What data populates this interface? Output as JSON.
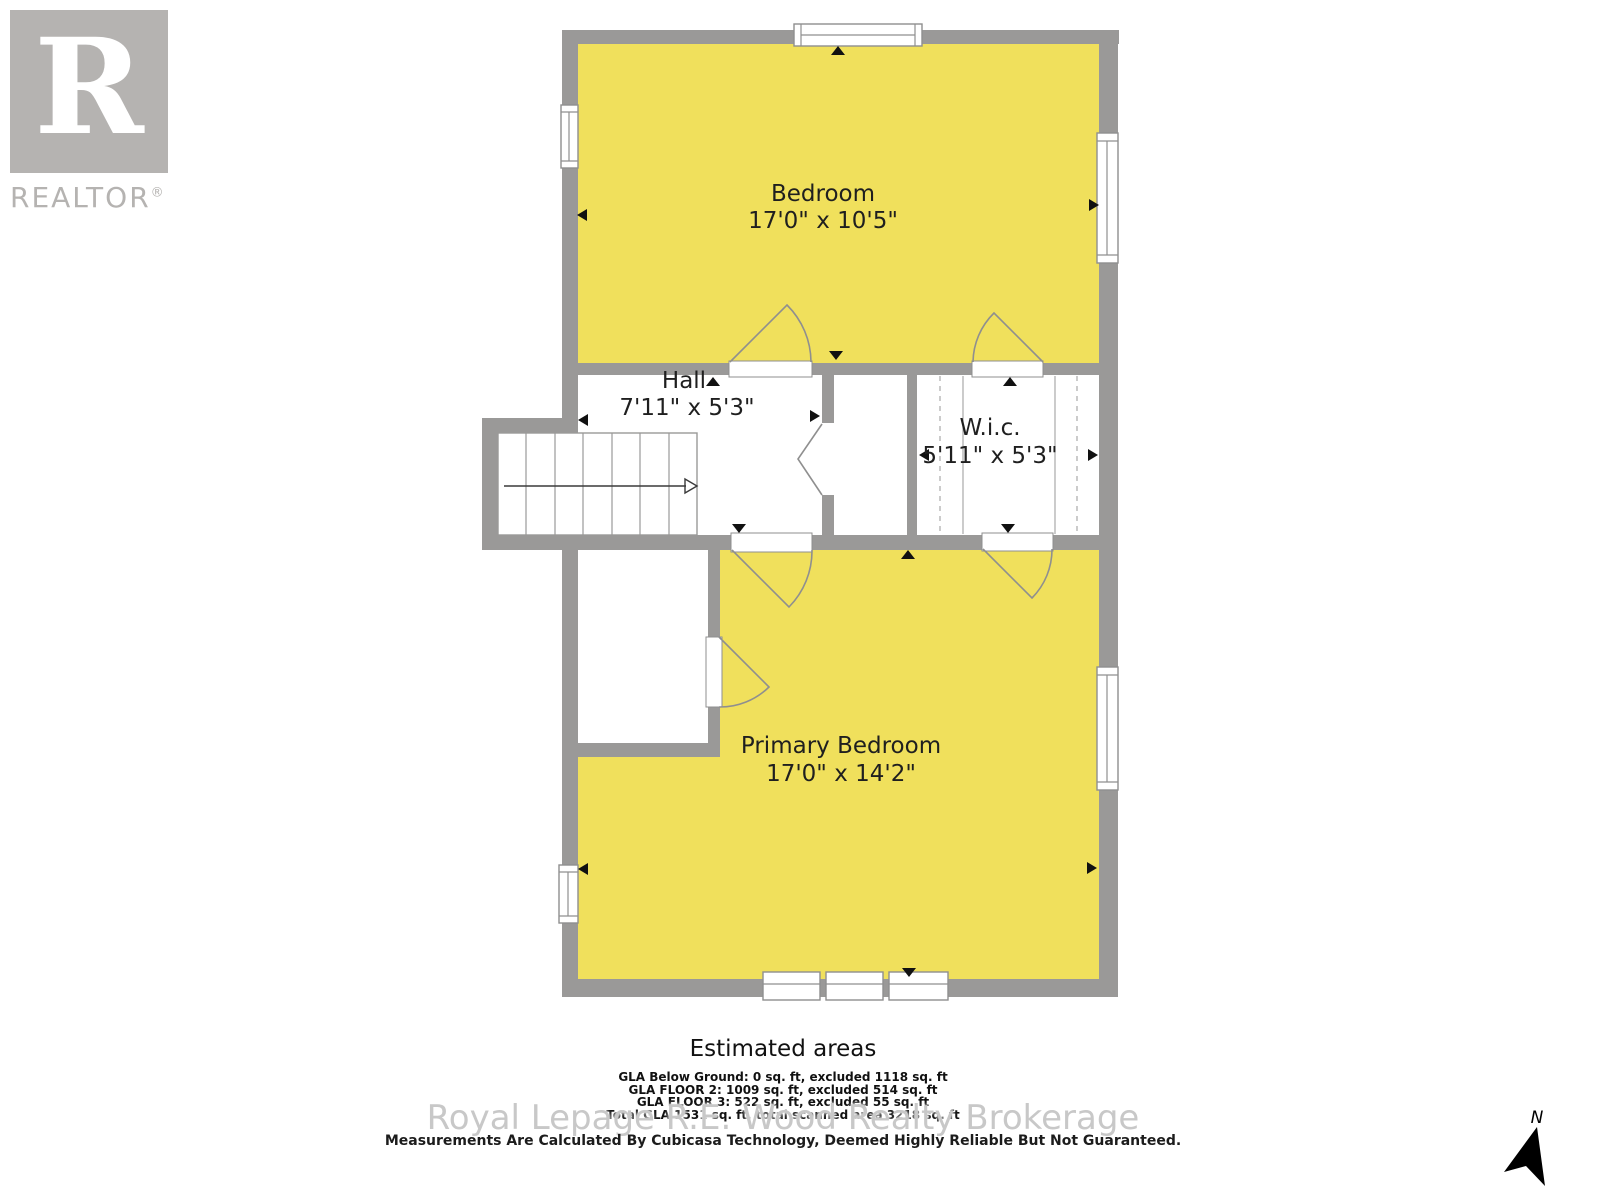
{
  "logo": {
    "letter": "R",
    "brand": "REALTOR",
    "registered": "®"
  },
  "rooms": [
    {
      "name": "Bedroom",
      "dims": "17'0\" x 10'5\""
    },
    {
      "name": "Hall",
      "dims": "7'11\" x 5'3\""
    },
    {
      "name": "W.i.c.",
      "dims": "5'11\" x 5'3\""
    },
    {
      "name": "Primary Bedroom",
      "dims": "17'0\" x 14'2\""
    }
  ],
  "areas": {
    "title": "Estimated areas",
    "lines": [
      "GLA Below Ground: 0 sq. ft, excluded 1118 sq. ft",
      "GLA FLOOR 2: 1009 sq. ft, excluded 514 sq. ft",
      "GLA FLOOR 3: 522 sq. ft, excluded 55 sq. ft",
      "Total GLA 1531 sq. ft, total scanned area 3218 sq. ft"
    ]
  },
  "watermark": "Royal Lepage R.E. Wood Realty Brokerage",
  "disclaimer": "Measurements Are Calculated By Cubicasa Technology, Deemed Highly Reliable But Not Guaranteed.",
  "compass": {
    "north_label": "N"
  },
  "colors": {
    "room_fill": "#f0e05c",
    "wall": "#9a9998",
    "outline": "#8f8f8f",
    "text": "#1f1f1f",
    "watermark": "#c8c8c8",
    "logo_gray": "#b5b3b1"
  }
}
